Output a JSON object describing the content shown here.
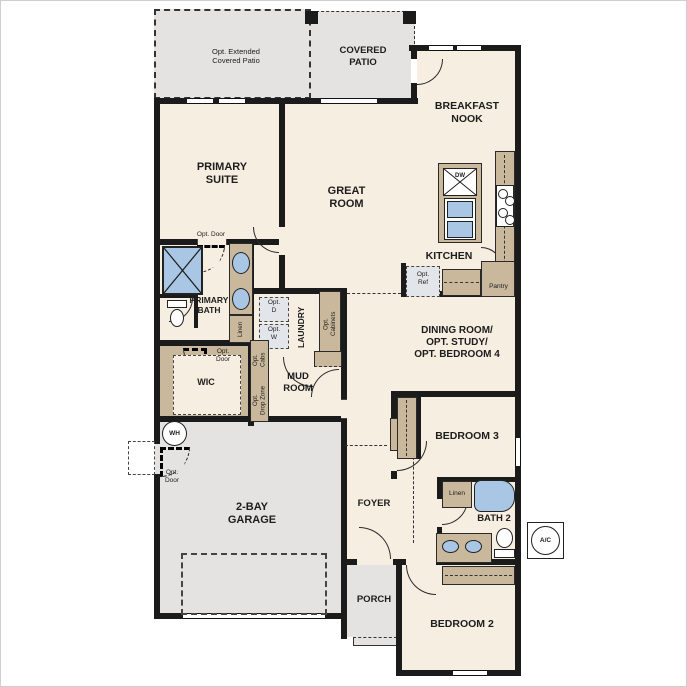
{
  "colors": {
    "floor": "#f6eee0",
    "garage_patio": "#e4e3e1",
    "cabinet_tan": "#c9b89c",
    "fixture_blue": "#a9c7e4",
    "wall": "#1b1b1b",
    "opt_box": "#e2e6ea"
  },
  "icons": {
    "wh": "water-heater-circle",
    "ac": "air-conditioner-circle",
    "shower": "shower-x",
    "dw": "dishwasher-x",
    "cooktop": "four-burner-cooktop",
    "toilet": "toilet",
    "tub": "bathtub",
    "sink": "oval-sink"
  },
  "labels": {
    "opt_extended_patio": "Opt. Extended\nCovered Patio",
    "covered_patio": "COVERED\nPATIO",
    "breakfast_nook": "BREAKFAST\nNOOK",
    "primary_suite": "PRIMARY\nSUITE",
    "great_room": "GREAT\nROOM",
    "kitchen": "KITCHEN",
    "dw": "DW",
    "opt_ref": "Opt.\nRef",
    "pantry": "Pantry",
    "dining": "DINING ROOM/\nOPT. STUDY/\nOPT. BEDROOM 4",
    "primary_bath": "PRIMARY\nBATH",
    "linen_primary": "Linen",
    "opt_door_suite": "Opt. Door",
    "opt_door_wic": "Opt.\nDoor",
    "opt_door_garage": "Opt.\nDoor",
    "wic": "WIC",
    "laundry": "LAUNDRY",
    "opt_d": "Opt.\nD",
    "opt_w": "Opt.\nW",
    "opt_cabs": "Opt.\nCabs",
    "opt_cabinets": "Opt.\nCabinets",
    "opt_drop_zone": "Opt.\nDrop Zone",
    "mud_room": "MUD\nROOM",
    "wh": "WH",
    "garage": "2-BAY\nGARAGE",
    "foyer": "FOYER",
    "porch": "PORCH",
    "bedroom3": "BEDROOM 3",
    "bath2": "BATH 2",
    "linen_bath2": "Linen",
    "bedroom2": "BEDROOM 2",
    "ac": "A/C"
  }
}
